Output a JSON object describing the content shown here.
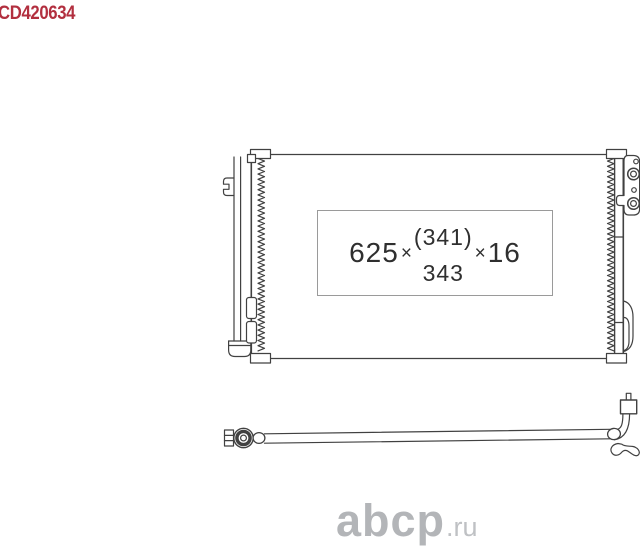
{
  "part_code": {
    "text": "CD420634",
    "color": "#b22f3f"
  },
  "dimension_label": {
    "width": "625",
    "times_1": "×",
    "height_alt": "(341)",
    "height": "343",
    "times_2": "×",
    "thickness": "16"
  },
  "watermark": {
    "brand": "abcp",
    "tld": ".ru",
    "color": "#b3b5b8"
  },
  "drawing": {
    "subject": "ac-condenser-with-receiver-drier-and-liquid-pipe",
    "line_color": "#414141",
    "parts": [
      "condenser-core",
      "receiver-drier",
      "mounting-bracket-left",
      "port-plate-top-right",
      "mounting-pin-bottom-right",
      "liquid-pipe-assembly",
      "service-valve"
    ]
  }
}
